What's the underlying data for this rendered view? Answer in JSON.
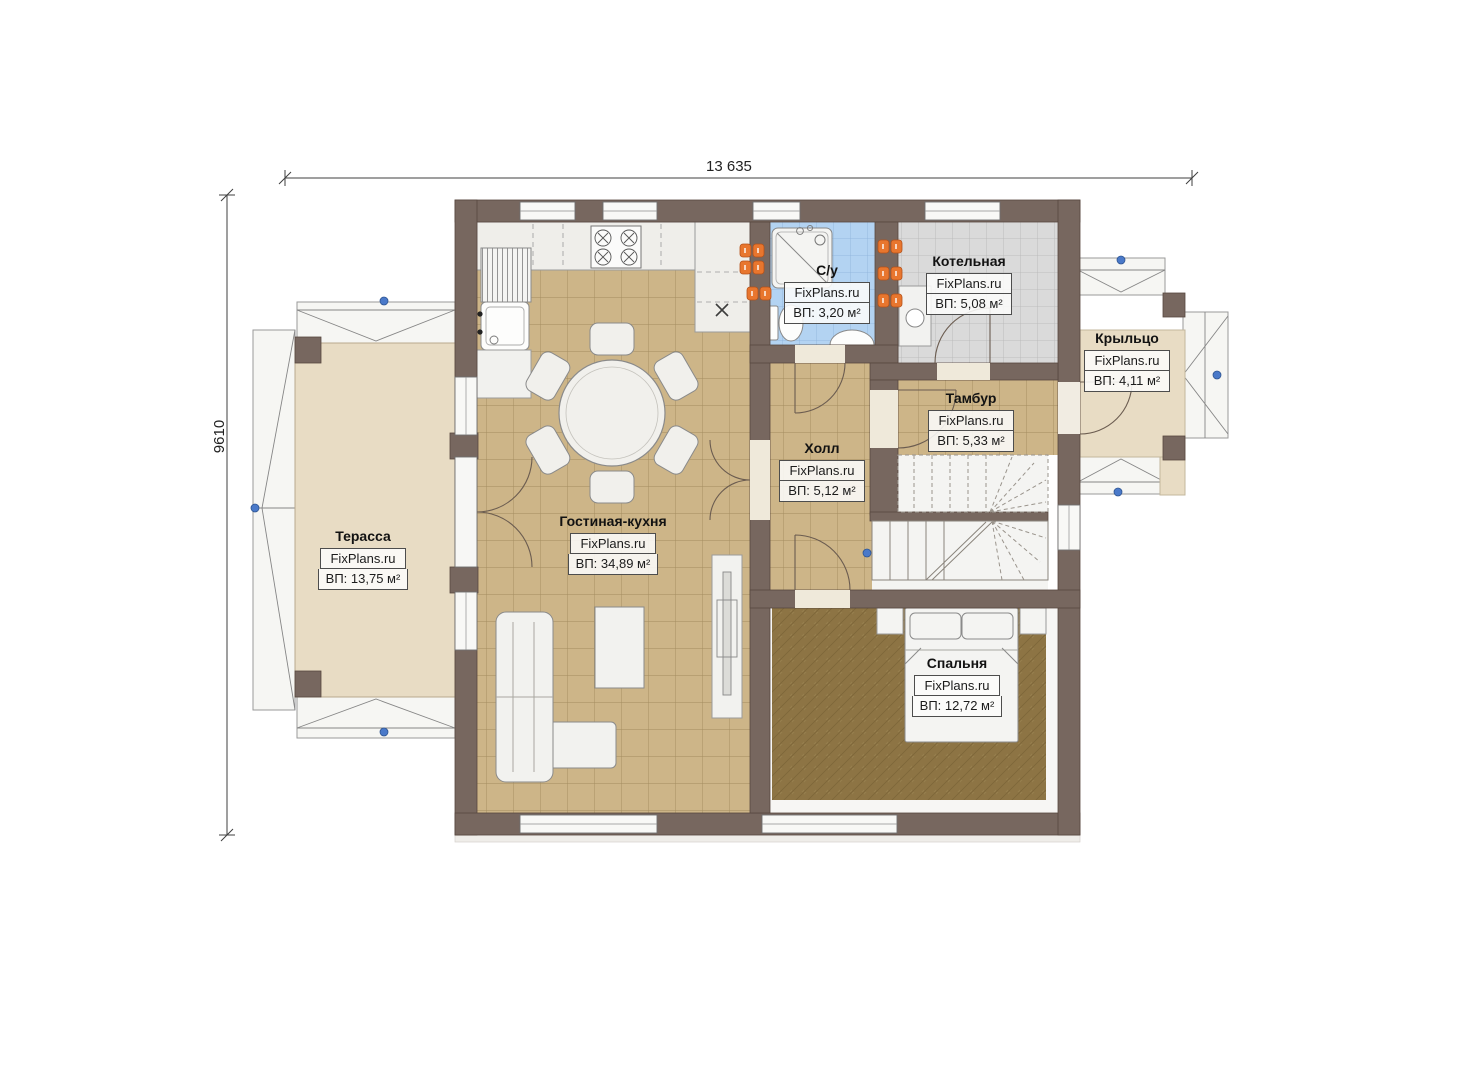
{
  "plan": {
    "source_watermark": "FixPlans.ru",
    "dimensions": {
      "overall_width": "13 635",
      "overall_height": "9610"
    },
    "rooms": [
      {
        "id": "terrace",
        "name": "Терасса",
        "watermark": "FixPlans.ru",
        "area_label": "ВП: 13,75 м²"
      },
      {
        "id": "living-kitchen",
        "name": "Гостиная-кухня",
        "watermark": "FixPlans.ru",
        "area_label": "ВП: 34,89 м²"
      },
      {
        "id": "bathroom",
        "name": "С/у",
        "watermark": "FixPlans.ru",
        "area_label": "ВП: 3,20 м²"
      },
      {
        "id": "boiler-room",
        "name": "Котельная",
        "watermark": "FixPlans.ru",
        "area_label": "ВП: 5,08 м²"
      },
      {
        "id": "porch",
        "name": "Крыльцо",
        "watermark": "FixPlans.ru",
        "area_label": "ВП: 4,11 м²"
      },
      {
        "id": "vestibule",
        "name": "Тамбур",
        "watermark": "FixPlans.ru",
        "area_label": "ВП: 5,33 м²"
      },
      {
        "id": "hall",
        "name": "Холл",
        "watermark": "FixPlans.ru",
        "area_label": "ВП: 5,12 м²"
      },
      {
        "id": "bedroom",
        "name": "Спальня",
        "watermark": "FixPlans.ru",
        "area_label": "ВП: 12,72 м²"
      }
    ],
    "colors": {
      "wall": "#77675f",
      "tile_tan": "#cdb588",
      "tile_blue": "#b3d3f2",
      "tile_gray": "#dadada",
      "carpet": "#8d7444",
      "terrace_floor": "#e8dcc4",
      "radiator_orange": "#e8762e",
      "marker_blue": "#4a79c9",
      "background": "#ffffff"
    }
  }
}
